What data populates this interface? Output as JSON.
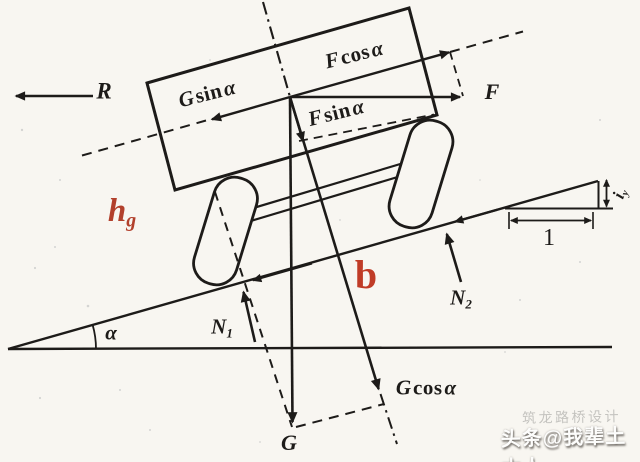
{
  "figure": {
    "description": "force diagram of vehicle on an inclined slope",
    "forces": {
      "R": "R",
      "F": "F",
      "G": "G",
      "gsin": {
        "v": "G",
        "fn": "sin",
        "a": "α"
      },
      "fcos": {
        "v": "F",
        "fn": "cos",
        "a": "α"
      },
      "fsin": {
        "v": "F",
        "fn": "sin",
        "a": "α"
      },
      "gcos": {
        "v": "G",
        "fn": "cos",
        "a": "α"
      },
      "n1": {
        "m": "N",
        "s": "1"
      },
      "n2": {
        "m": "N",
        "s": "2"
      }
    },
    "dims": {
      "hg": {
        "m": "h",
        "s": "g"
      },
      "b": "b",
      "alpha": "α",
      "iy": {
        "m": "i",
        "s": "y"
      },
      "unit_run": "1"
    },
    "colors": {
      "ink": "#1d1b19",
      "red_label": "#b2402c",
      "red_label_b": "#c03c27",
      "paper": "#f8f6f1"
    }
  },
  "watermark": {
    "text": "头条@我辈土木人",
    "ghost": "筑龙路桥设计"
  }
}
